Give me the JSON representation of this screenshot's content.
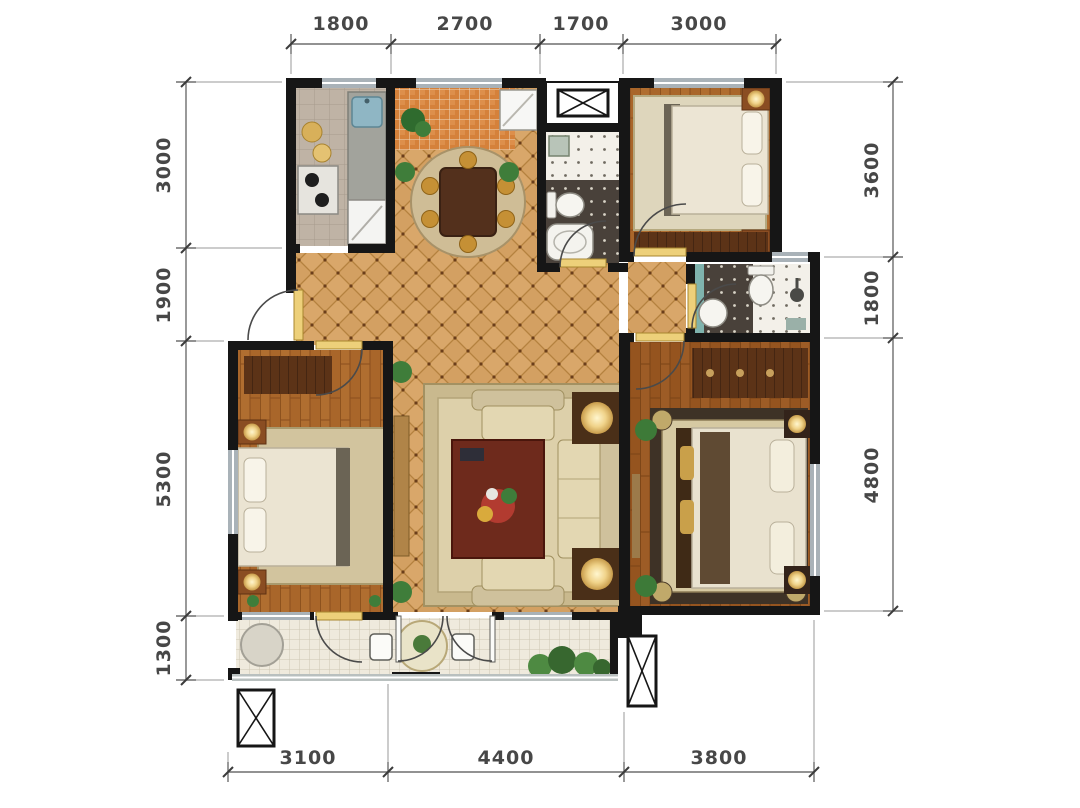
{
  "dimensions": {
    "top": [
      "1800",
      "2700",
      "1700",
      "3000"
    ],
    "left": [
      "3000",
      "1900",
      "5300",
      "1300"
    ],
    "right": [
      "3600",
      "1800",
      "4800"
    ],
    "bottom": [
      "3100",
      "4400",
      "3800"
    ]
  },
  "colors": {
    "wall": "#161616",
    "hall_tile": "#d9a76a",
    "wood_floor": "#a9662a",
    "entry_tile": "#d5813a",
    "balcony_tile": "#efeadd"
  }
}
